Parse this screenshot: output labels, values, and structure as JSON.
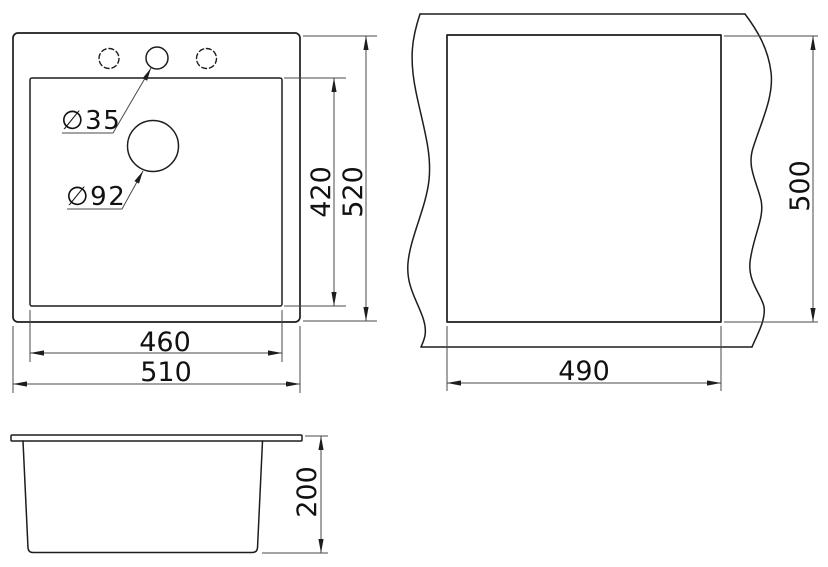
{
  "meta": {
    "background_color": "#ffffff",
    "object_line_color": "#1d1d1d",
    "dimension_line_color": "#4a4a4a",
    "text_color": "#111111"
  },
  "plan_view": {
    "dims": {
      "inner_height": "420",
      "outer_height": "520",
      "inner_width": "460",
      "outer_width": "510"
    },
    "holes": {
      "faucet_diameter": "∅35",
      "drain_diameter": "∅92"
    }
  },
  "cutout_view": {
    "dims": {
      "height": "500",
      "width": "490"
    }
  },
  "side_view": {
    "dims": {
      "depth": "200"
    }
  }
}
